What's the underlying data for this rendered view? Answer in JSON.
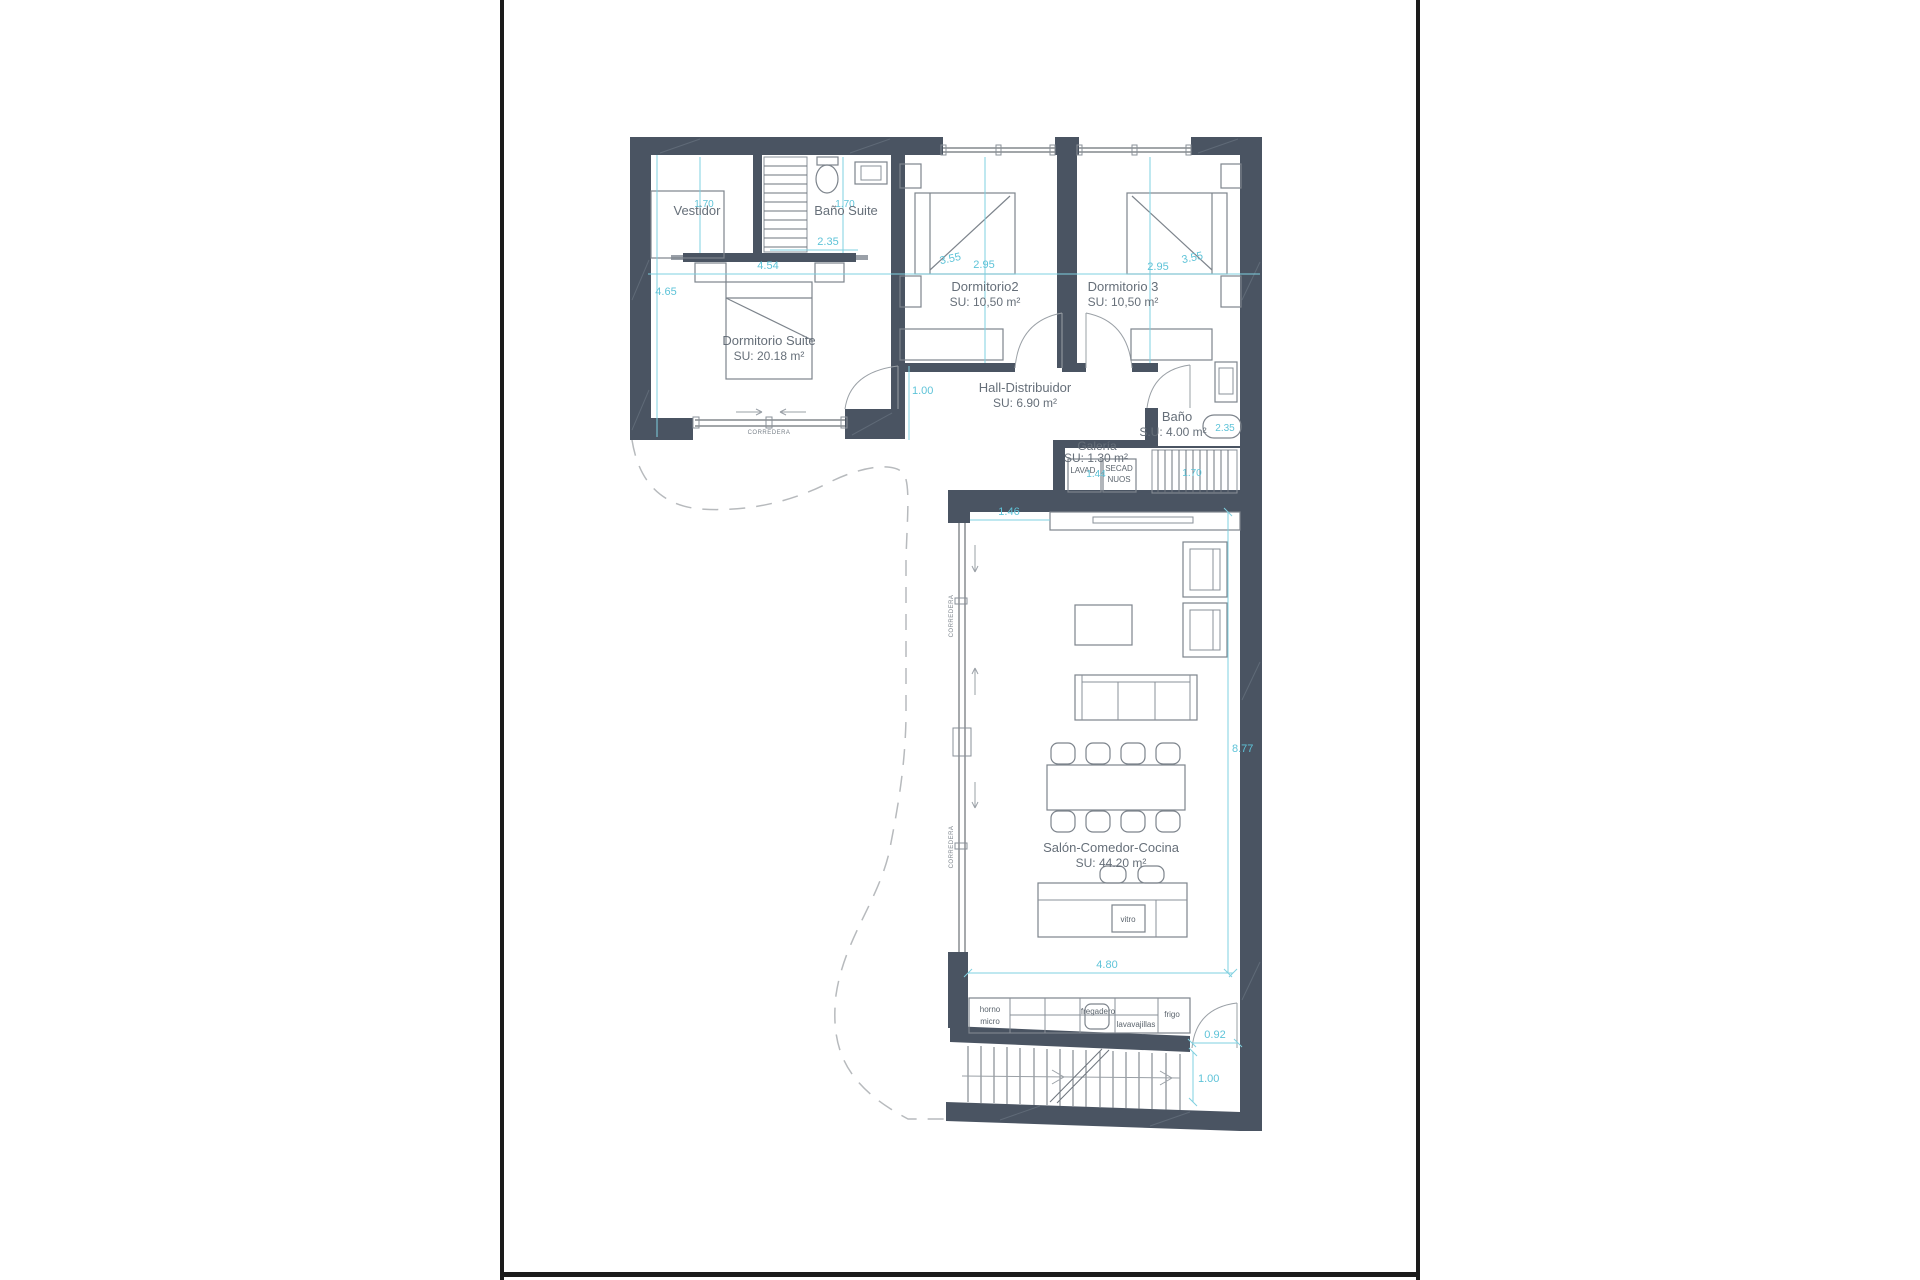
{
  "colors": {
    "wall": "#4a5462",
    "dimension": "#5ec3d8",
    "label": "#666f79",
    "page_border": "#1b1b1b",
    "background": "#ffffff"
  },
  "rooms": {
    "vestidor": {
      "label": "Vestidor"
    },
    "bano_suite": {
      "label": "Baño Suite"
    },
    "dormitorio_suite": {
      "label": "Dormitorio Suite",
      "area": "SU: 20.18 m²"
    },
    "dormitorio2": {
      "label": "Dormitorio2",
      "area": "SU: 10,50 m²"
    },
    "dormitorio3": {
      "label": "Dormitorio 3",
      "area": "SU: 10,50 m²"
    },
    "hall": {
      "label": "Hall-Distribuidor",
      "area": "SU: 6.90 m²"
    },
    "galeria": {
      "label": "Galería",
      "area": "SU: 1.30 m²"
    },
    "bano": {
      "label": "Baño",
      "area": "S.U: 4.00 m²"
    },
    "salon": {
      "label": "Salón-Comedor-Cocina",
      "area": "SU: 44.20 m²"
    }
  },
  "dimensions": {
    "suite_height": "4.65",
    "vestidor_width": "1.70",
    "bano_suite_width": "1.70",
    "bano_suite_depth": "2.35",
    "suite_width": "4.54",
    "dorm2_depth": "3.55",
    "dorm2_width": "2.95",
    "dorm3_width": "2.95",
    "dorm3_depth": "3.55",
    "hall_entry": "1.00",
    "galeria_width": "1.44",
    "mid_stairs_width": "1.70",
    "bano_width": "2.35",
    "salon_gap": "1.46",
    "salon_depth": "8.77",
    "salon_width": "4.80",
    "kitchen_door": "0.92",
    "stairs_run": "1.00"
  },
  "fixtures": {
    "lavadora": "LAVAD.",
    "secadora_line1": "SECAD",
    "secadora_line2": "NUOS",
    "vitro": "vitro",
    "horno_line1": "horno",
    "horno_line2": "micro",
    "fregadero": "fregadero",
    "lavavajillas": "lavavajillas",
    "frigo": "frigo",
    "corredera": "CORREDERA"
  }
}
